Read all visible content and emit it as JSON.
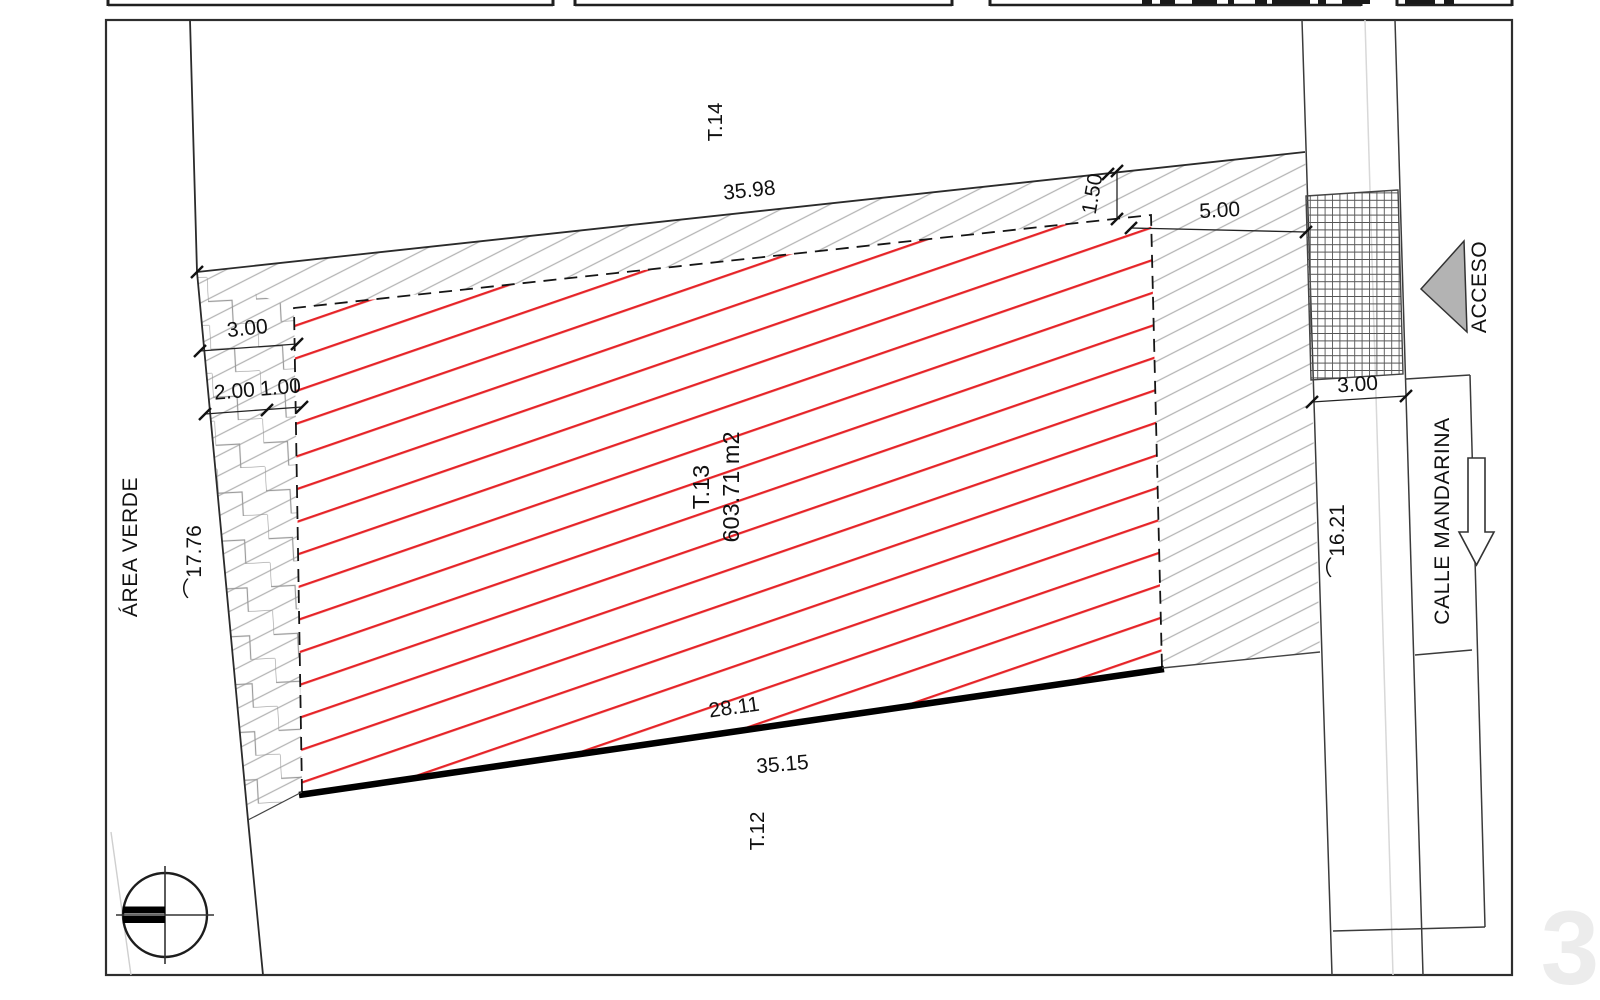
{
  "page": {
    "watermark_number": "3"
  },
  "plan": {
    "lot": {
      "id": "T.13",
      "area": "603.71 m2"
    },
    "adjacent_lots": {
      "north": "T.14",
      "south": "T.12"
    },
    "zones": {
      "green_area": "ÁREA VERDE",
      "street": "CALLE MANDARINA",
      "access": "ACCESO"
    },
    "dimensions": {
      "rear_boundary": "35.98",
      "rear_setback": "1.50",
      "right_setback": "5.00",
      "sidewalk_width": "3.00",
      "street_frontage_arc": "⌒16.21",
      "left_setback": "3.00",
      "left_split_a": "2.00",
      "left_split_b": "1.00",
      "green_boundary_arc": "⌒17.76",
      "front_partial": "28.11",
      "front_total": "35.15"
    },
    "colors": {
      "lot_hatch_red": "#e62428",
      "setback_hatch_grey": "#b4b4b4",
      "access_triangle_grey": "#b3b3b3",
      "watermark_grey": "#ececec"
    },
    "icons": {
      "north": "north-symbol-icon",
      "access": "access-triangle-icon",
      "street_direction": "street-direction-arrow-icon"
    }
  }
}
